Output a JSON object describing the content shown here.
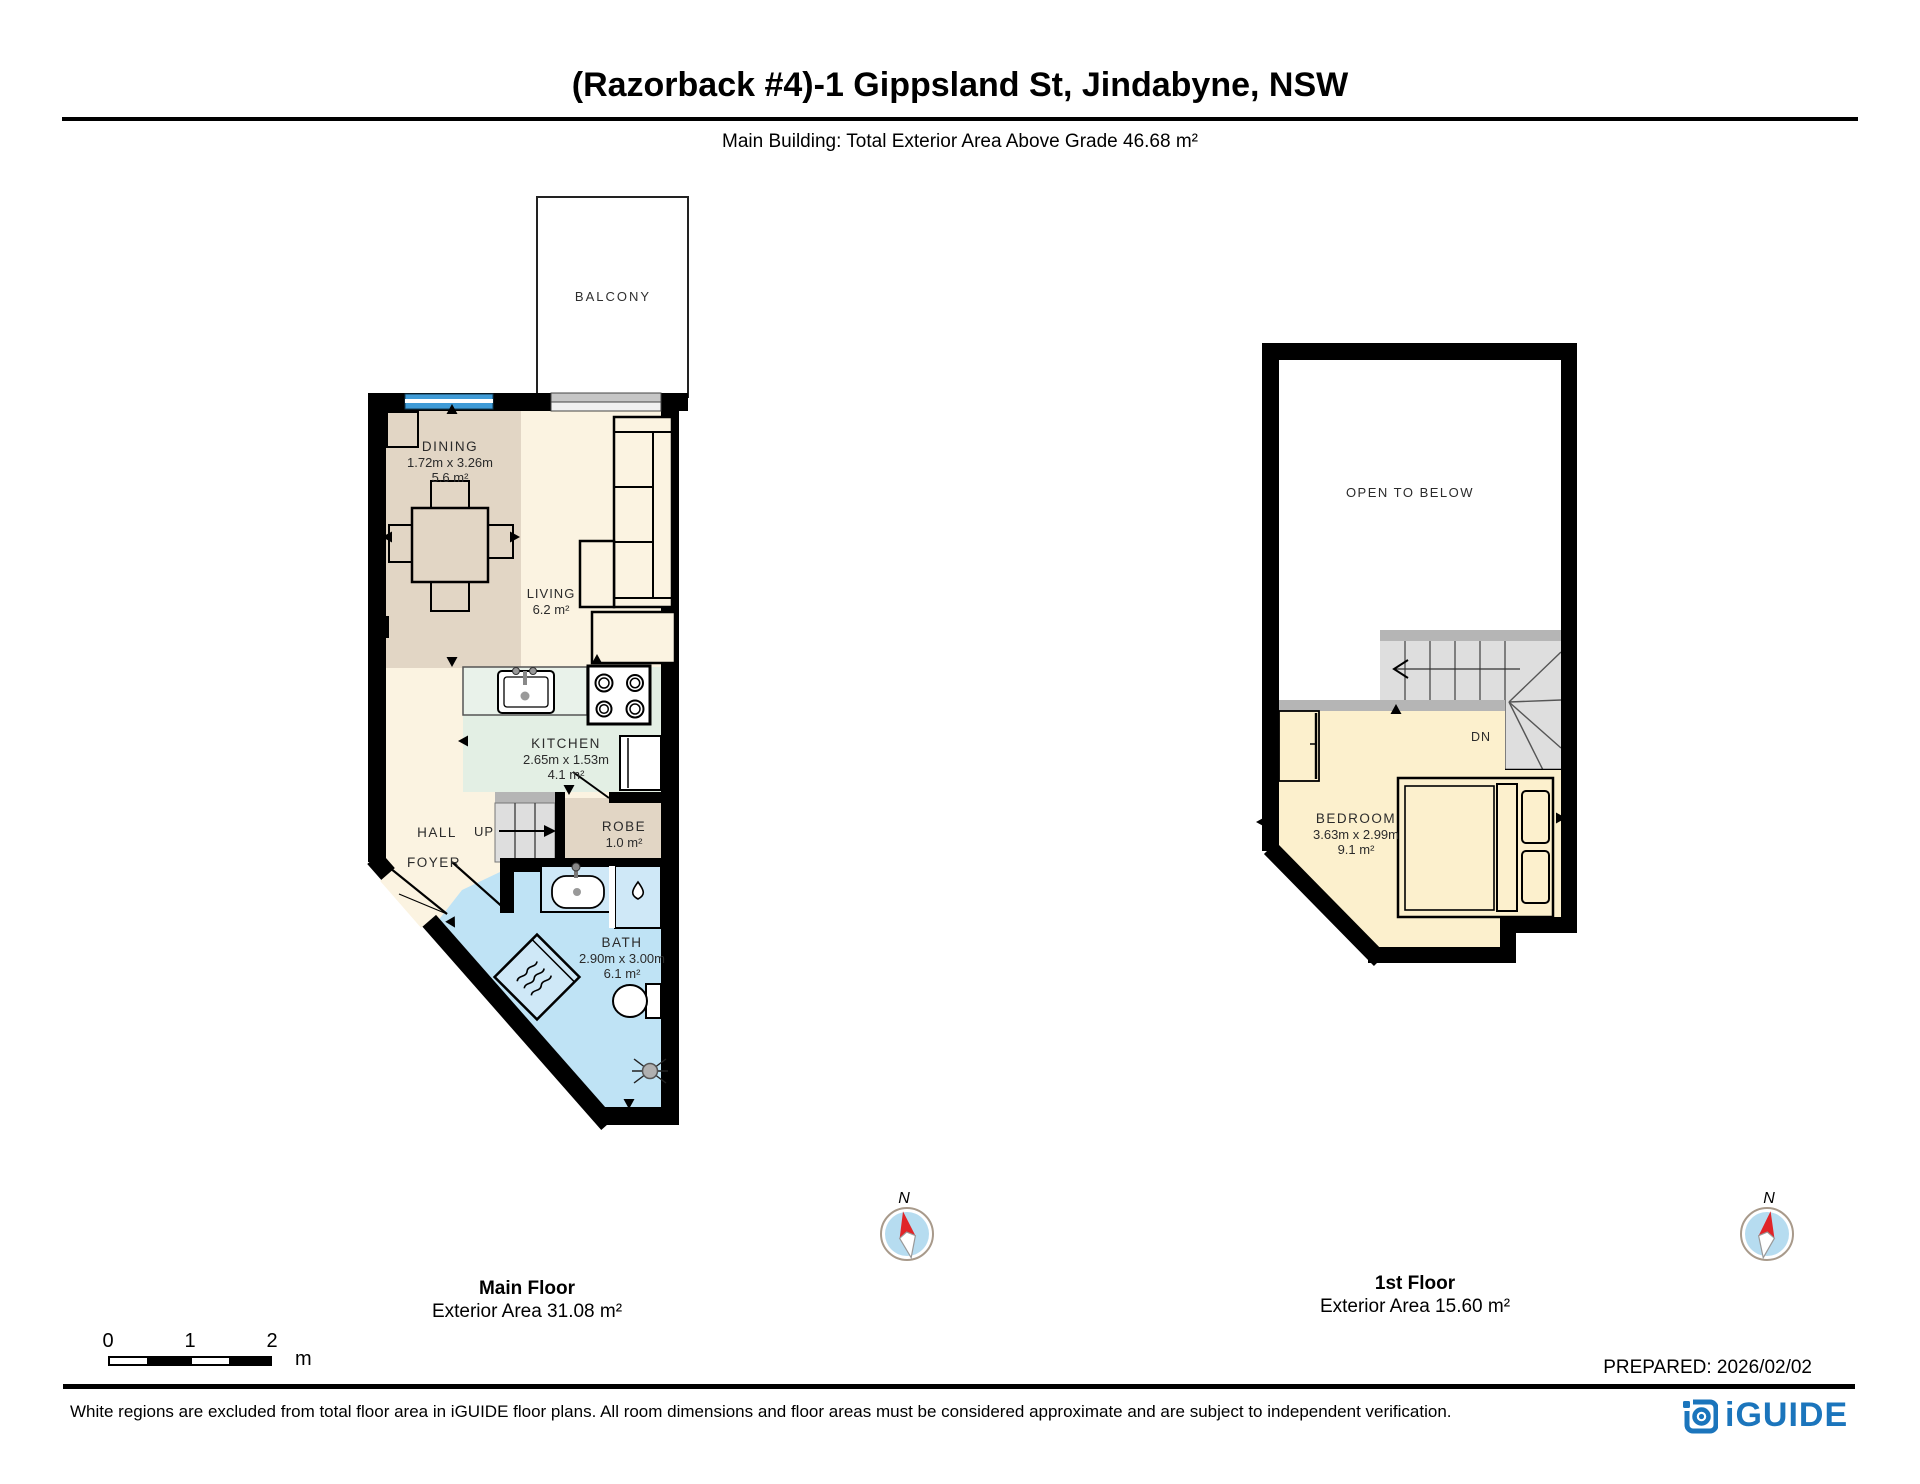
{
  "header": {
    "title": "(Razorback #4)-1 Gippsland St, Jindabyne, NSW",
    "subtitle": "Main Building: Total Exterior Area Above Grade 46.68 m²"
  },
  "main_floor": {
    "floor_label": "Main Floor",
    "floor_area": "Exterior Area 31.08 m²",
    "rooms": {
      "balcony": {
        "label": "BALCONY"
      },
      "dining": {
        "label": "DINING",
        "dims": "1.72m x 3.26m",
        "area": "5.6 m²"
      },
      "living": {
        "label": "LIVING",
        "area": "6.2 m²"
      },
      "kitchen": {
        "label": "KITCHEN",
        "dims": "2.65m x 1.53m",
        "area": "4.1 m²"
      },
      "hall": {
        "label": "HALL"
      },
      "stairs": {
        "label": "UP"
      },
      "foyer": {
        "label": "FOYER"
      },
      "robe": {
        "label": "ROBE",
        "area": "1.0 m²"
      },
      "bath": {
        "label": "BATH",
        "dims": "2.90m x 3.00m",
        "area": "6.1 m²"
      }
    }
  },
  "first_floor": {
    "floor_label": "1st Floor",
    "floor_area": "Exterior Area 15.60 m²",
    "rooms": {
      "open_to_below": {
        "label": "OPEN TO BELOW"
      },
      "stairs": {
        "label": "DN"
      },
      "bedroom": {
        "label": "BEDROOM",
        "dims": "3.63m x 2.99m",
        "area": "9.1 m²"
      }
    }
  },
  "compass": {
    "north_label": "N"
  },
  "scale_bar": {
    "ticks": [
      "0",
      "1",
      "2"
    ],
    "unit": "m"
  },
  "prepared_label": "PREPARED: 2026/02/02",
  "footer": {
    "disclaimer": "White regions are excluded from total floor area in iGUIDE floor plans. All room dimensions and floor areas must be considered approximate and are subject to independent verification.",
    "brand": "iGUIDE"
  },
  "colors": {
    "wall": "#000000",
    "dining": "#e2d6c5",
    "cream": "#fbf3e1",
    "kitchen": "#e3efe4",
    "counter": "#e9f2ea",
    "robe": "#e2d6c5",
    "bath": "#bfe3f5",
    "fixture": "#cfe8f7",
    "bedroom": "#fcf0cd",
    "stair_gray": "#dedede",
    "stair_cap": "#b5b5b5",
    "window_blue": "#3f9bd7",
    "compass_disc": "#b6dcf0",
    "needle_red": "#e02428",
    "brand_blue": "#1b75bc"
  }
}
